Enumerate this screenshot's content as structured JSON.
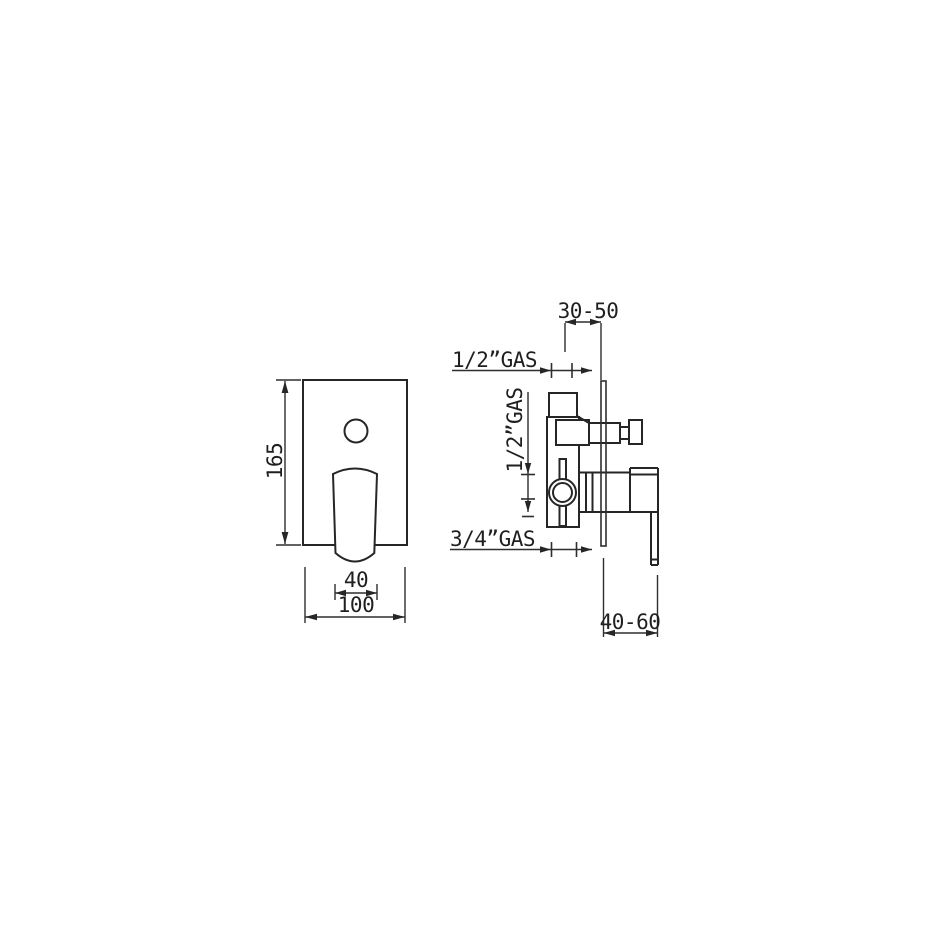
{
  "drawing": {
    "type": "technical-dimension-drawing",
    "views": [
      "front",
      "side"
    ],
    "colors": {
      "background": "#ffffff",
      "line": "#262626",
      "text": "#1f1f1f"
    },
    "front_view": {
      "dim_plate_height": "165",
      "dim_handle_width": "40",
      "dim_plate_width": "100"
    },
    "side_view": {
      "dim_depth_top": "30-50",
      "dim_depth_bottom": "40-60",
      "label_top_connection": "1/2”GAS",
      "label_side_connection": "1/2”GAS",
      "label_bottom_connection": "3/4”GAS"
    }
  }
}
